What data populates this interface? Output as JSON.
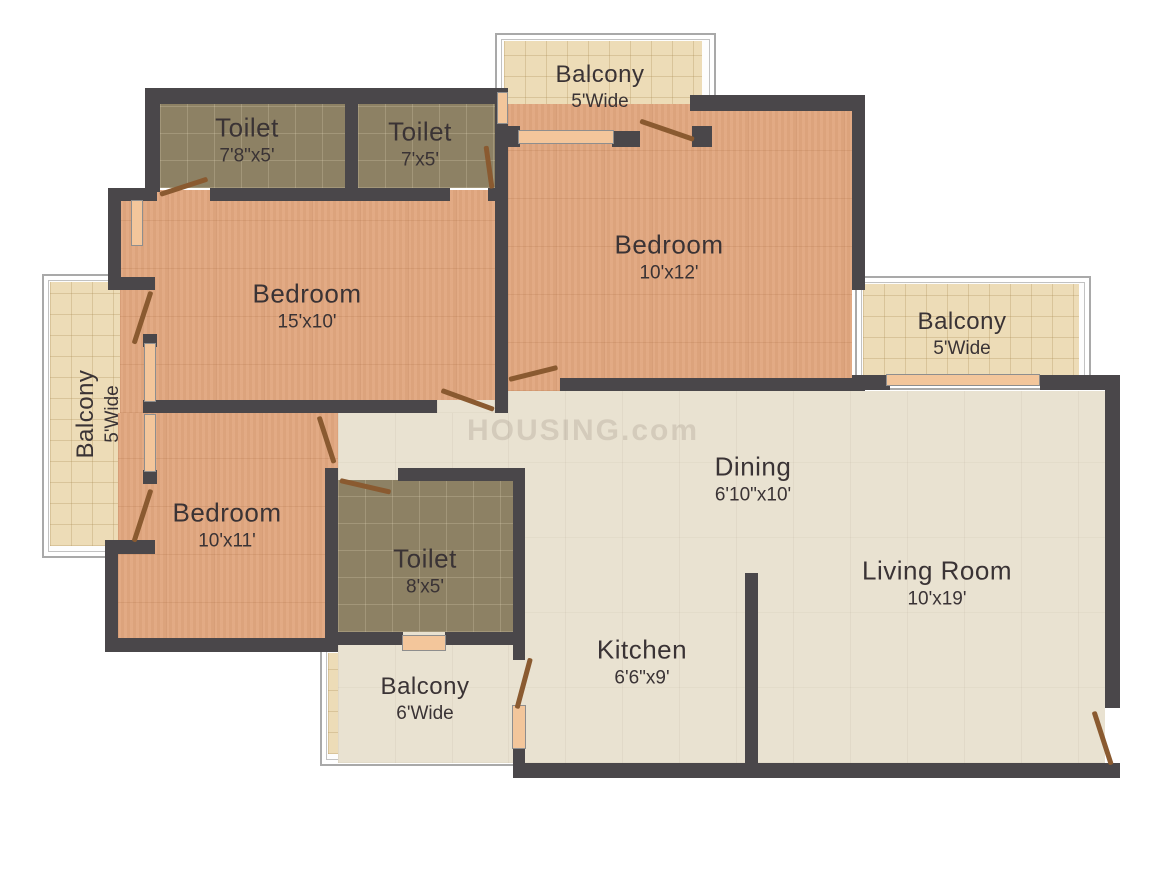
{
  "watermark": "HOUSING.com",
  "colors": {
    "wall": "#4a474a",
    "bedroom_floor": "#e0a67e",
    "toilet_floor": "#8d8164",
    "balcony_floor": "#eddcb7",
    "living_floor": "#e9e2d1",
    "door_leaf": "#8a5a30",
    "window_sill": "#f3c69b",
    "label_text": "#3a3335"
  },
  "rooms": {
    "toilet_top_left": {
      "name": "Toilet",
      "dims": "7'8\"x5'"
    },
    "toilet_top_mid": {
      "name": "Toilet",
      "dims": "7'x5'"
    },
    "balcony_top": {
      "name": "Balcony",
      "dims": "5'Wide"
    },
    "bedroom_top_right": {
      "name": "Bedroom",
      "dims": "10'x12'"
    },
    "bedroom_left": {
      "name": "Bedroom",
      "dims": "15'x10'"
    },
    "balcony_left": {
      "name": "Balcony",
      "dims": "5'Wide"
    },
    "balcony_right": {
      "name": "Balcony",
      "dims": "5'Wide"
    },
    "bedroom_bottom_left": {
      "name": "Bedroom",
      "dims": "10'x11'"
    },
    "toilet_center": {
      "name": "Toilet",
      "dims": "8'x5'"
    },
    "dining": {
      "name": "Dining",
      "dims": "6'10\"x10'"
    },
    "living_room": {
      "name": "Living Room",
      "dims": "10'x19'"
    },
    "kitchen": {
      "name": "Kitchen",
      "dims": "6'6\"x9'"
    },
    "balcony_bottom": {
      "name": "Balcony",
      "dims": "6'Wide"
    }
  }
}
